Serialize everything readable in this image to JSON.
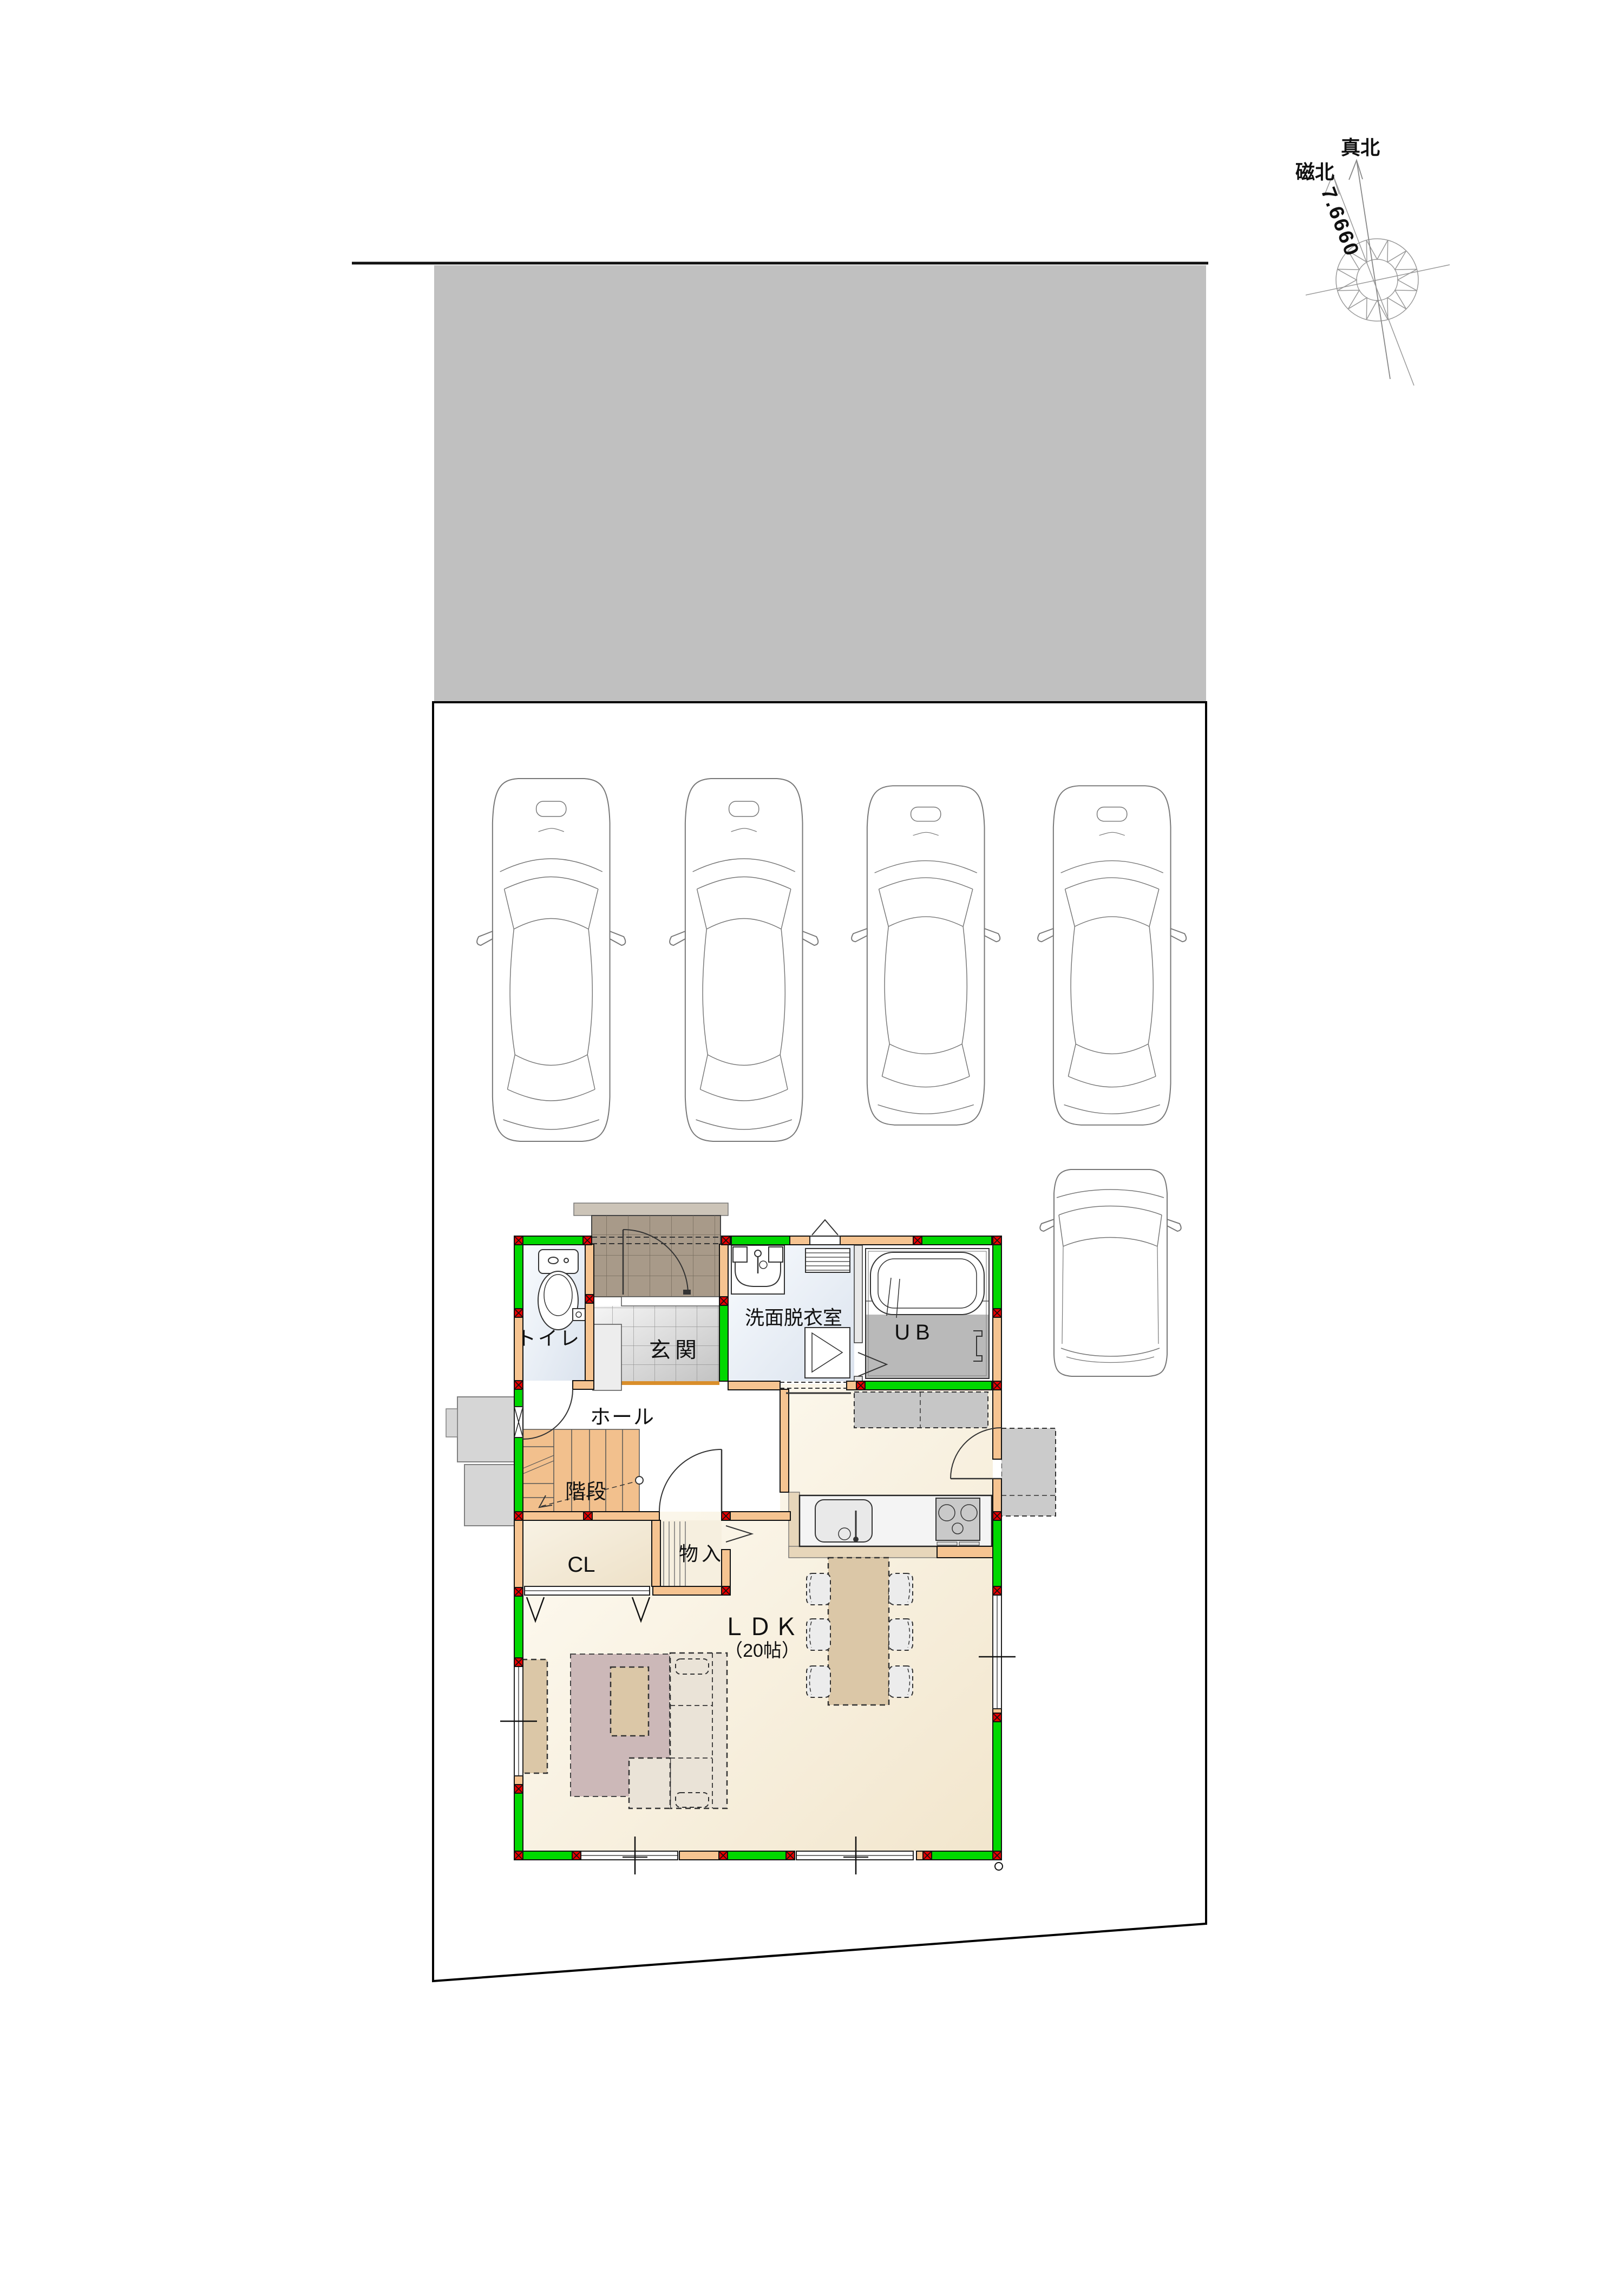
{
  "compass": {
    "true_north": "真北",
    "magnetic_north": "磁北",
    "declination": "7.6660"
  },
  "rooms": {
    "toilet": "トイレ",
    "entrance": "玄関",
    "washroom": "洗面脱衣室",
    "bath": "UB",
    "hall": "ホール",
    "stairs": "階段",
    "closet": "CL",
    "storage": "物入",
    "ldk": "ＬＤＫ",
    "ldk_size": "（20帖）"
  },
  "site": {
    "cars_parked_top_row": 4,
    "cars_parked_side": 1,
    "adjacent_lot_color": "#c0c0c0",
    "parcel_outline_color": "#000000"
  },
  "legend_colors": {
    "exterior_wall_green": "#00d800",
    "interior_wall_orange": "#f6c491",
    "structural_column_red": "#e60000",
    "porch_tile": "#a89a89",
    "unit_bath_floor": "#b9b9b9",
    "rug": "#ccb8b8"
  }
}
